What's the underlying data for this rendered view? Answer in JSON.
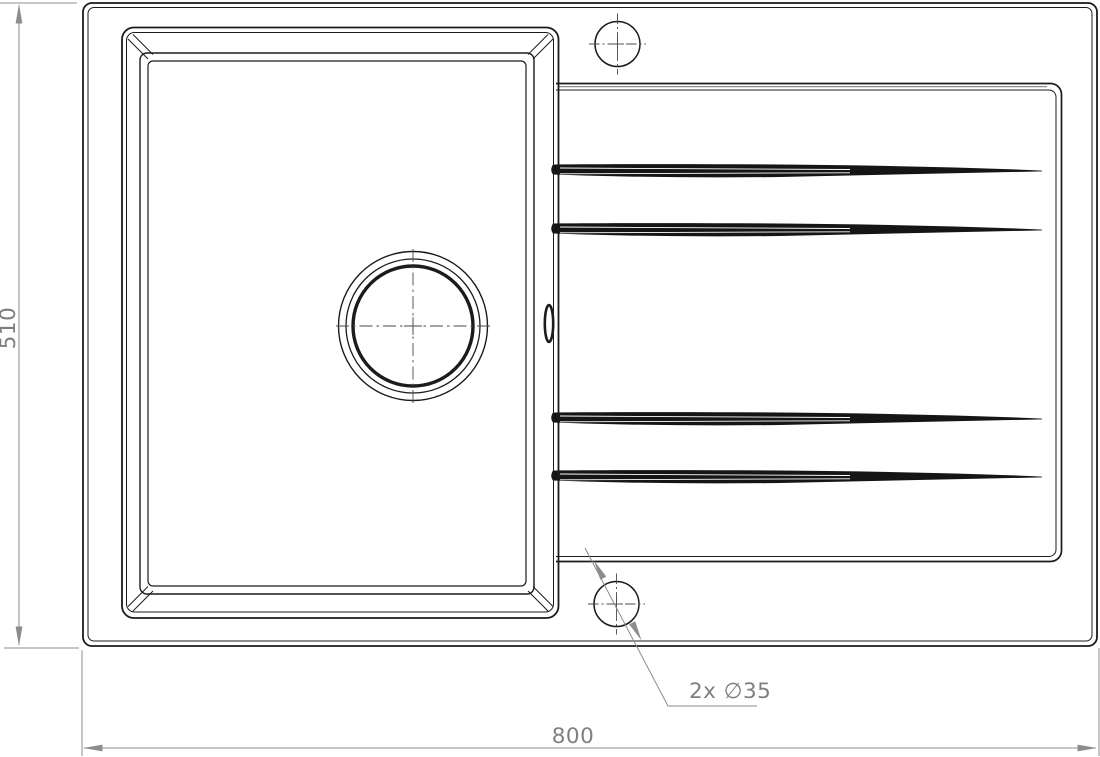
{
  "drawing": {
    "title": "kitchen-sink-top-view-technical-drawing",
    "labels": {
      "width": "800",
      "height": "510",
      "holes": "2x ∅35"
    },
    "features": {
      "tap_hole_count": 2,
      "tap_hole_diameter_mm": 35,
      "overall_width_mm": 800,
      "overall_depth_mm": 510,
      "drainboard_grooves": 4
    }
  },
  "colors": {
    "object_line": "#1b1b1b",
    "dimension_line": "#8c8c8c",
    "label_text": "#7f7f7f",
    "background": "#ffffff"
  }
}
